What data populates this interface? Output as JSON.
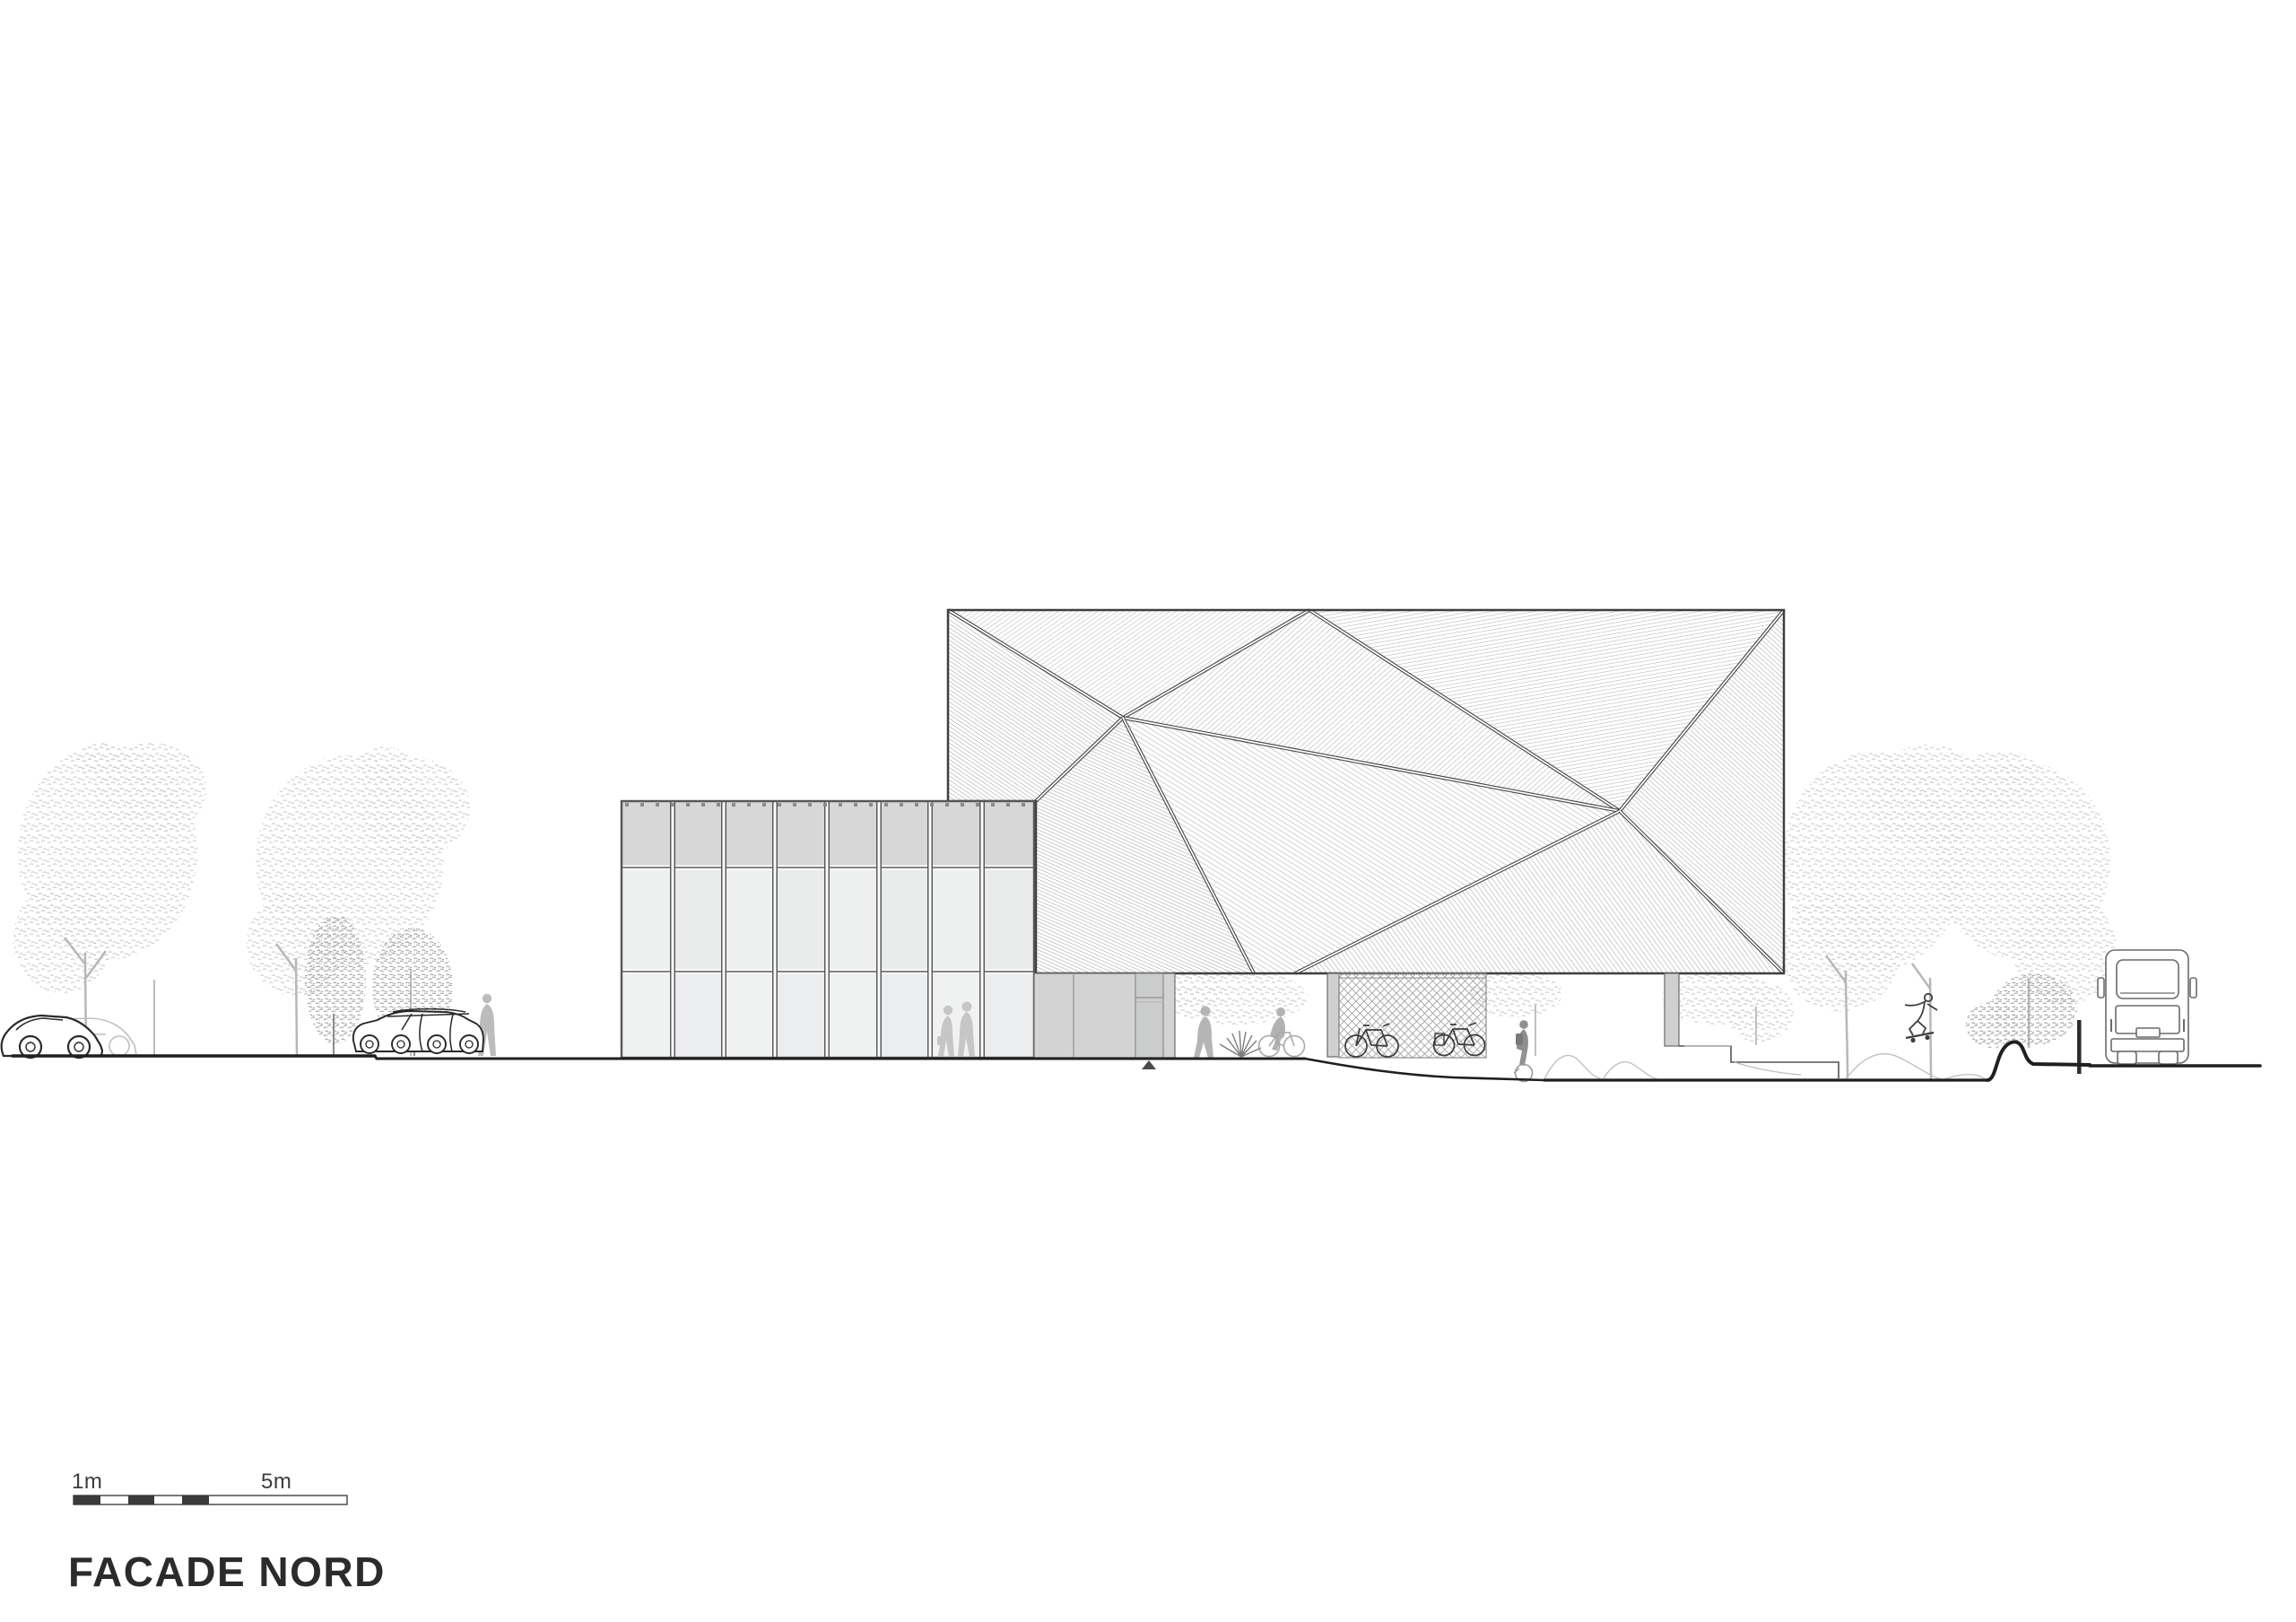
{
  "drawing": {
    "title": "FACADE NORD",
    "scale_bar": {
      "label_small": "1m",
      "label_large": "5m"
    }
  },
  "palette": {
    "ink": "#2b2b2b",
    "outline": "#3f3f3f",
    "annex_frame": "#565656",
    "hatch_line": "#9f9f9f",
    "panel_top_band": "#d7d7d7",
    "panel_glass_a": "#eef0f0",
    "panel_glass_b": "#eaecec",
    "ground_bay": "#d3d3d3",
    "foliage_light": "#c6c6c6",
    "foliage_dark": "#9e9e9e",
    "silhouette_light": "#c6c6c6",
    "silhouette_mid": "#b0b0b0",
    "scale_bar_fill": "#3a3a3a"
  }
}
